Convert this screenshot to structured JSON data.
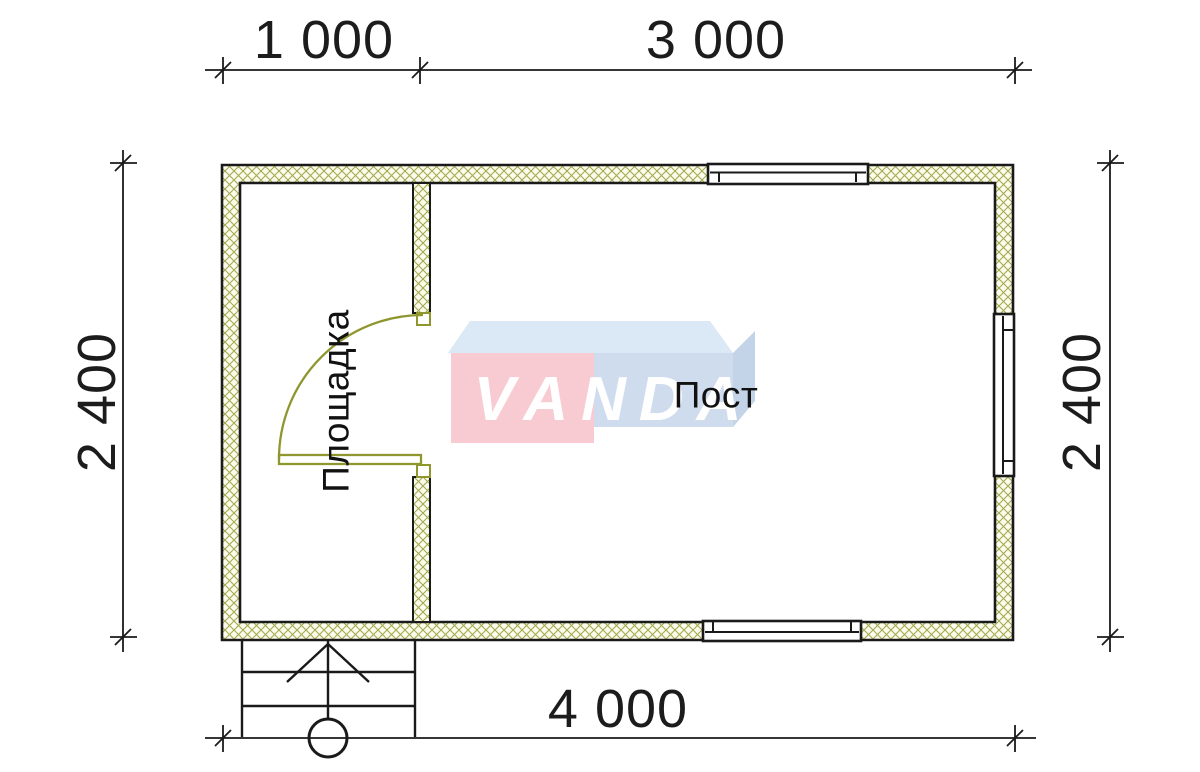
{
  "drawing": {
    "type": "floor-plan",
    "dimensions": {
      "top_left": "1 000",
      "top_right": "3 000",
      "left": "2 400",
      "right": "2 400",
      "bottom": "4 000"
    },
    "rooms": {
      "platform": "Площадка",
      "post": "Пост"
    },
    "symbols": [
      "door-swing",
      "window-top",
      "window-bottom",
      "window-right",
      "staircase-with-arrow",
      "column-circle"
    ]
  },
  "watermark": {
    "text": "VANDA"
  },
  "colors": {
    "wall_line": "#1a1a1a",
    "hatch_line": "#a3aa4e",
    "hatch_bg": "#fcfcee",
    "door_line": "#8f962e",
    "logo_pink": "#f7cbd1",
    "logo_blue": "#cfdcee",
    "logo_blue_top": "#dbe8f5",
    "logo_blue_side": "#c3d4e8"
  }
}
